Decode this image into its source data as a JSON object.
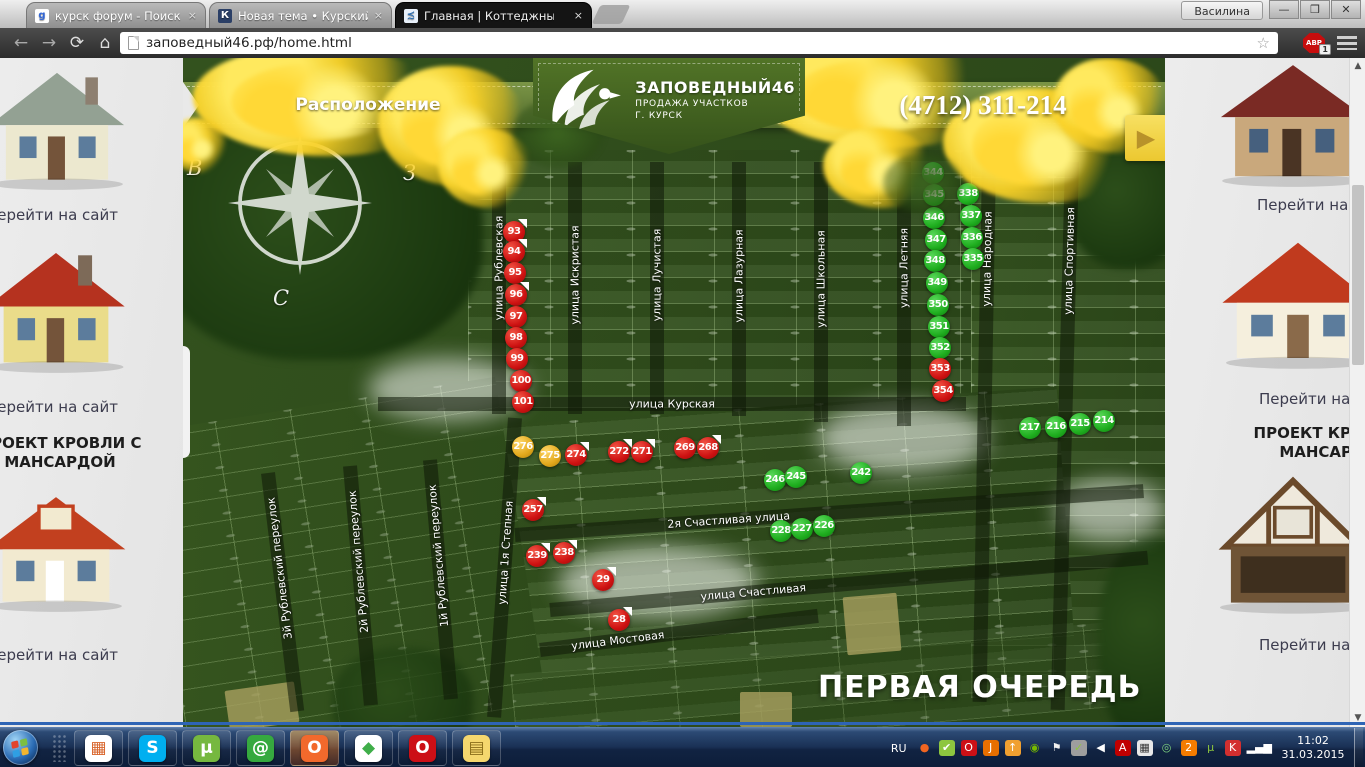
{
  "browser": {
    "user_button": "Василина",
    "tabs": [
      {
        "label": "курск форум - Поиск в G",
        "active": false
      },
      {
        "label": "Новая тема • Курский Фо",
        "active": false
      },
      {
        "label": "Главная | Коттеджный по",
        "active": true
      }
    ],
    "tab_close_glyph": "×",
    "url": "заповедный46.рф/home.html",
    "abp_label": "ABP",
    "abp_badge": "1",
    "icons": {
      "back": "←",
      "forward": "→",
      "refresh": "⟳",
      "home": "⌂",
      "star": "☆"
    },
    "win_controls": {
      "minimize": "—",
      "maximize": "❒",
      "close": "✕"
    }
  },
  "header": {
    "nav_label": "Расположение",
    "logo_title": "ЗАПОВЕДНЫЙ46",
    "logo_subtitle1": "ПРОДАЖА УЧАСТКОВ",
    "logo_subtitle2": "Г. КУРСК",
    "phone": "(4712) 311-214",
    "arrow_glyph": "▶"
  },
  "map": {
    "phase_label": "ПЕРВАЯ ОЧЕРЕДЬ",
    "compass": {
      "left_letter": "В",
      "right_letter": "З",
      "bottom_letter": "С"
    },
    "status_colors": {
      "sold": "#ce1212",
      "available": "#1fae1f",
      "reserved": "#e2a81c"
    },
    "streets": [
      {
        "name": "улица Рублевская",
        "dir": "v",
        "x": 316,
        "y": 104,
        "len": 252,
        "angle": 0,
        "label_frac": 0.42
      },
      {
        "name": "улица Искристая",
        "dir": "v",
        "x": 392,
        "y": 104,
        "len": 252,
        "angle": 0,
        "label_frac": 0.45
      },
      {
        "name": "улица Лучистая",
        "dir": "v",
        "x": 474,
        "y": 104,
        "len": 252,
        "angle": 0,
        "label_frac": 0.45
      },
      {
        "name": "улица Лазурная",
        "dir": "v",
        "x": 556,
        "y": 104,
        "len": 254,
        "angle": 0,
        "label_frac": 0.45
      },
      {
        "name": "улица Школьная",
        "dir": "v",
        "x": 638,
        "y": 104,
        "len": 260,
        "angle": 0,
        "label_frac": 0.45
      },
      {
        "name": "улица Летняя",
        "dir": "v",
        "x": 721,
        "y": 104,
        "len": 264,
        "angle": 0,
        "label_frac": 0.4
      },
      {
        "name": "улица Народная",
        "dir": "v",
        "x": 806,
        "y": 104,
        "len": 540,
        "angle": 1,
        "label_frac": 0.18
      },
      {
        "name": "улица Спортивная",
        "dir": "v",
        "x": 889,
        "y": 104,
        "len": 548,
        "angle": 1.5,
        "label_frac": 0.18
      },
      {
        "name": "улица Курская",
        "dir": "h",
        "x": 195,
        "y": 346,
        "len": 588,
        "angle": 0,
        "label_frac": 0.5
      },
      {
        "name": "2я Счастливая улица",
        "dir": "h",
        "x": 332,
        "y": 477,
        "len": 630,
        "angle": -4,
        "label_frac": 0.34
      },
      {
        "name": "улица Счастливая",
        "dir": "h",
        "x": 367,
        "y": 552,
        "len": 600,
        "angle": -5,
        "label_frac": 0.34
      },
      {
        "name": "улица Мостовая",
        "dir": "h",
        "x": 357,
        "y": 592,
        "len": 280,
        "angle": -7,
        "label_frac": 0.28
      },
      {
        "name": "улица 1я Степная",
        "dir": "v",
        "x": 332,
        "y": 360,
        "len": 300,
        "angle": 4,
        "label_frac": 0.45
      },
      {
        "name": "1й Рублевский переулок",
        "dir": "v",
        "x": 247,
        "y": 402,
        "len": 240,
        "angle": -5,
        "label_frac": 0.4
      },
      {
        "name": "2й Рублевский переулок",
        "dir": "v",
        "x": 167,
        "y": 408,
        "len": 240,
        "angle": -5,
        "label_frac": 0.4
      },
      {
        "name": "3й Рублевский переулок",
        "dir": "v",
        "x": 85,
        "y": 415,
        "len": 240,
        "angle": -7,
        "label_frac": 0.4
      }
    ],
    "markers": [
      {
        "num": "93",
        "x": 331,
        "y": 174,
        "status": "red",
        "flag": true
      },
      {
        "num": "94",
        "x": 331,
        "y": 194,
        "status": "red",
        "flag": true
      },
      {
        "num": "95",
        "x": 332,
        "y": 215,
        "status": "red",
        "flag": false
      },
      {
        "num": "96",
        "x": 333,
        "y": 237,
        "status": "red",
        "flag": true
      },
      {
        "num": "97",
        "x": 333,
        "y": 259,
        "status": "red",
        "flag": false
      },
      {
        "num": "98",
        "x": 333,
        "y": 280,
        "status": "red",
        "flag": false
      },
      {
        "num": "99",
        "x": 334,
        "y": 301,
        "status": "red",
        "flag": false
      },
      {
        "num": "100",
        "x": 338,
        "y": 323,
        "status": "red",
        "flag": false
      },
      {
        "num": "101",
        "x": 340,
        "y": 344,
        "status": "red",
        "flag": false
      },
      {
        "num": "276",
        "x": 340,
        "y": 389,
        "status": "yellow",
        "flag": false
      },
      {
        "num": "275",
        "x": 367,
        "y": 398,
        "status": "yellow",
        "flag": false
      },
      {
        "num": "274",
        "x": 393,
        "y": 397,
        "status": "red",
        "flag": true
      },
      {
        "num": "272",
        "x": 436,
        "y": 394,
        "status": "red",
        "flag": true
      },
      {
        "num": "271",
        "x": 459,
        "y": 394,
        "status": "red",
        "flag": true
      },
      {
        "num": "269",
        "x": 502,
        "y": 390,
        "status": "red",
        "flag": false
      },
      {
        "num": "268",
        "x": 525,
        "y": 390,
        "status": "red",
        "flag": true
      },
      {
        "num": "257",
        "x": 350,
        "y": 452,
        "status": "red",
        "flag": true
      },
      {
        "num": "239",
        "x": 354,
        "y": 498,
        "status": "red",
        "flag": true
      },
      {
        "num": "238",
        "x": 381,
        "y": 495,
        "status": "red",
        "flag": true
      },
      {
        "num": "29",
        "x": 420,
        "y": 522,
        "status": "red",
        "flag": true
      },
      {
        "num": "28",
        "x": 436,
        "y": 562,
        "status": "red",
        "flag": true
      },
      {
        "num": "246",
        "x": 592,
        "y": 422,
        "status": "green",
        "flag": false
      },
      {
        "num": "245",
        "x": 613,
        "y": 419,
        "status": "green",
        "flag": false
      },
      {
        "num": "242",
        "x": 678,
        "y": 415,
        "status": "green",
        "flag": false
      },
      {
        "num": "228",
        "x": 598,
        "y": 473,
        "status": "green",
        "flag": false
      },
      {
        "num": "227",
        "x": 619,
        "y": 471,
        "status": "green",
        "flag": false
      },
      {
        "num": "226",
        "x": 641,
        "y": 468,
        "status": "green",
        "flag": false
      },
      {
        "num": "217",
        "x": 847,
        "y": 370,
        "status": "green",
        "flag": false
      },
      {
        "num": "216",
        "x": 873,
        "y": 369,
        "status": "green",
        "flag": false
      },
      {
        "num": "215",
        "x": 897,
        "y": 366,
        "status": "green",
        "flag": false
      },
      {
        "num": "214",
        "x": 921,
        "y": 363,
        "status": "green",
        "flag": false
      },
      {
        "num": "344",
        "x": 750,
        "y": 115,
        "status": "green",
        "flag": false
      },
      {
        "num": "345",
        "x": 751,
        "y": 137,
        "status": "green",
        "flag": false
      },
      {
        "num": "346",
        "x": 751,
        "y": 160,
        "status": "green",
        "flag": false
      },
      {
        "num": "347",
        "x": 753,
        "y": 182,
        "status": "green",
        "flag": false
      },
      {
        "num": "348",
        "x": 752,
        "y": 203,
        "status": "green",
        "flag": false
      },
      {
        "num": "349",
        "x": 754,
        "y": 225,
        "status": "green",
        "flag": false
      },
      {
        "num": "350",
        "x": 755,
        "y": 247,
        "status": "green",
        "flag": false
      },
      {
        "num": "351",
        "x": 756,
        "y": 269,
        "status": "green",
        "flag": false
      },
      {
        "num": "352",
        "x": 757,
        "y": 290,
        "status": "green",
        "flag": false
      },
      {
        "num": "353",
        "x": 757,
        "y": 311,
        "status": "red",
        "flag": false
      },
      {
        "num": "354",
        "x": 760,
        "y": 333,
        "status": "red",
        "flag": false
      },
      {
        "num": "338",
        "x": 785,
        "y": 136,
        "status": "green",
        "flag": false
      },
      {
        "num": "337",
        "x": 788,
        "y": 158,
        "status": "green",
        "flag": false
      },
      {
        "num": "336",
        "x": 789,
        "y": 180,
        "status": "green",
        "flag": false
      },
      {
        "num": "335",
        "x": 790,
        "y": 201,
        "status": "green",
        "flag": false
      }
    ]
  },
  "sidebar_left": {
    "link_label": "Перейти на сайт",
    "heading_line1": "ПРОЕКТ КРОВЛИ С",
    "heading_line2": "МАНСАРДОЙ"
  },
  "sidebar_right": {
    "link_label": "Перейти на сайт",
    "heading_line1": "ПРОЕКТ КРОВЛИ С",
    "heading_line2": "МАНСАРДОЙ"
  },
  "scrollbar": {
    "up": "▲",
    "down": "▼"
  },
  "taskbar": {
    "language": "RU",
    "time": "11:02",
    "date": "31.03.2015",
    "pinned": [
      {
        "name": "app-launcher",
        "glyph": "▦",
        "bg": "#ffffff",
        "fg": "#d8642a",
        "hl": false
      },
      {
        "name": "skype",
        "glyph": "S",
        "bg": "#00aff0",
        "fg": "#ffffff",
        "hl": false
      },
      {
        "name": "utorrent",
        "glyph": "µ",
        "bg": "#76b83f",
        "fg": "#ffffff",
        "hl": false
      },
      {
        "name": "mailru-agent",
        "glyph": "@",
        "bg": "#36a93f",
        "fg": "#ffffff",
        "hl": false
      },
      {
        "name": "origin",
        "glyph": "O",
        "bg": "#f2692c",
        "fg": "#ffffff",
        "hl": true
      },
      {
        "name": "sims",
        "glyph": "◆",
        "bg": "#ffffff",
        "fg": "#3fae49",
        "hl": false
      },
      {
        "name": "opera",
        "glyph": "O",
        "bg": "#cc0f16",
        "fg": "#ffffff",
        "hl": false
      },
      {
        "name": "file-explorer",
        "glyph": "▤",
        "bg": "#f5d76e",
        "fg": "#8a6d1a",
        "hl": false
      }
    ],
    "tray": [
      {
        "name": "origin",
        "glyph": "●",
        "color": "#f16521"
      },
      {
        "name": "updater",
        "glyph": "✔",
        "color": "#ffffff",
        "bg": "#8dc63f"
      },
      {
        "name": "opera",
        "glyph": "O",
        "color": "#ffffff",
        "bg": "#cc1016"
      },
      {
        "name": "java",
        "glyph": "J",
        "color": "#ffffff",
        "bg": "#e76f00"
      },
      {
        "name": "uploader",
        "glyph": "↑",
        "color": "#ffffff",
        "bg": "#f0a030"
      },
      {
        "name": "nvidia",
        "glyph": "◉",
        "color": "#76b900"
      },
      {
        "name": "action-center-flag",
        "glyph": "⚑",
        "color": "#f0f0f0"
      },
      {
        "name": "usb-device",
        "glyph": "✓",
        "color": "#8dc63f",
        "bg": "#9e9e9e"
      },
      {
        "name": "volume",
        "glyph": "◀",
        "color": "#ffffff"
      },
      {
        "name": "adobe-reader",
        "glyph": "A",
        "color": "#ffffff",
        "bg": "#c00000"
      },
      {
        "name": "keyboard",
        "glyph": "▦",
        "color": "#333333",
        "bg": "#e8e8e8"
      },
      {
        "name": "eye",
        "glyph": "◎",
        "color": "#7fd47f"
      },
      {
        "name": "avast",
        "glyph": "2",
        "color": "#ffffff",
        "bg": "#f57c00"
      },
      {
        "name": "utorrent",
        "glyph": "µ",
        "color": "#8dc63f"
      },
      {
        "name": "kaspersky",
        "glyph": "K",
        "color": "#ffffff",
        "bg": "#d32f2f"
      },
      {
        "name": "network-signal",
        "glyph": "▂▄▆",
        "color": "#ffffff"
      }
    ]
  }
}
